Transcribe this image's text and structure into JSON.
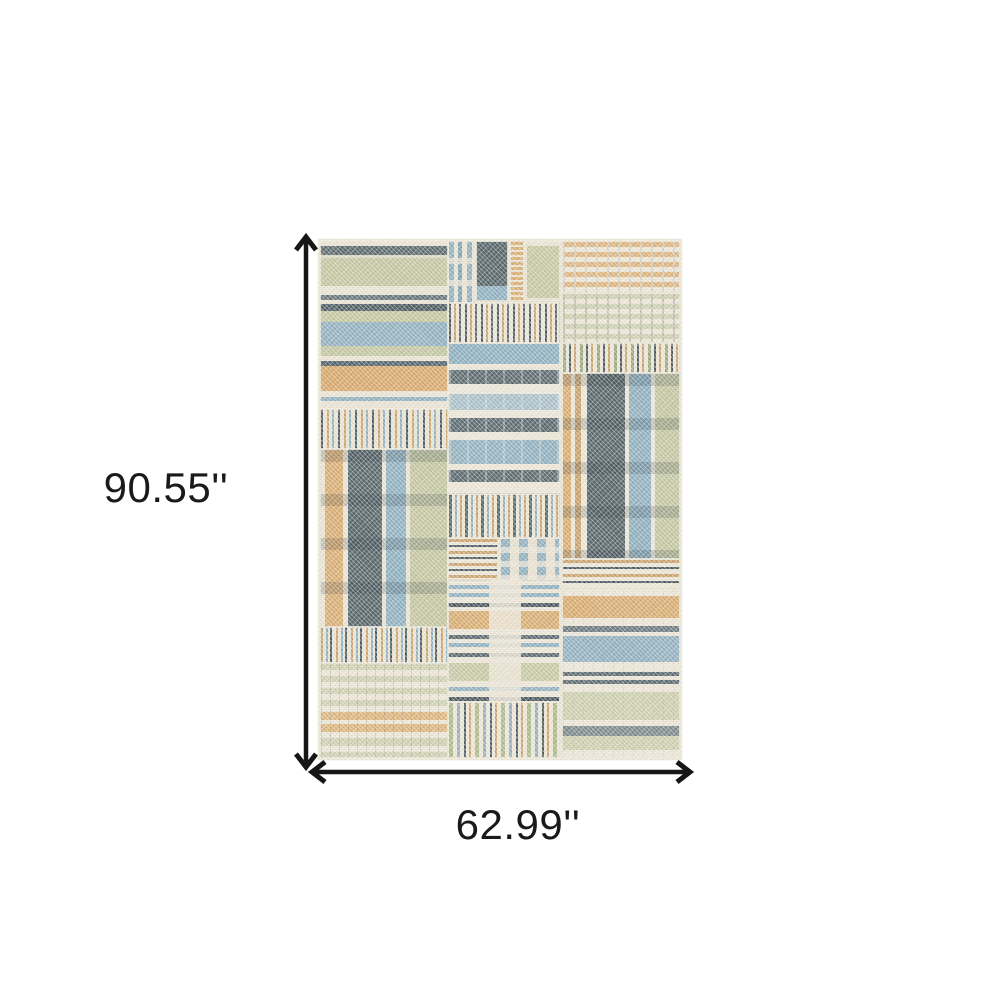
{
  "product_diagram": {
    "height_label": "90.55''",
    "width_label": "62.99''"
  },
  "icons": {
    "height_arrow": "double-headed-vertical-arrow",
    "width_arrow": "double-headed-horizontal-arrow"
  },
  "palette": {
    "background": "#ffffff",
    "annotation": "#1a1a1a",
    "rug_cream": "#ece6d7",
    "rug_sage": "#c3c7a1",
    "rug_sage_light": "#cfd1b2",
    "rug_blue": "#92b1c0",
    "rug_blue_light": "#a9c0c9",
    "rug_slate": "#57666b",
    "rug_slate_dark": "#4a585e",
    "rug_gold": "#d9ad72",
    "rug_gold_light": "#deb37c"
  }
}
